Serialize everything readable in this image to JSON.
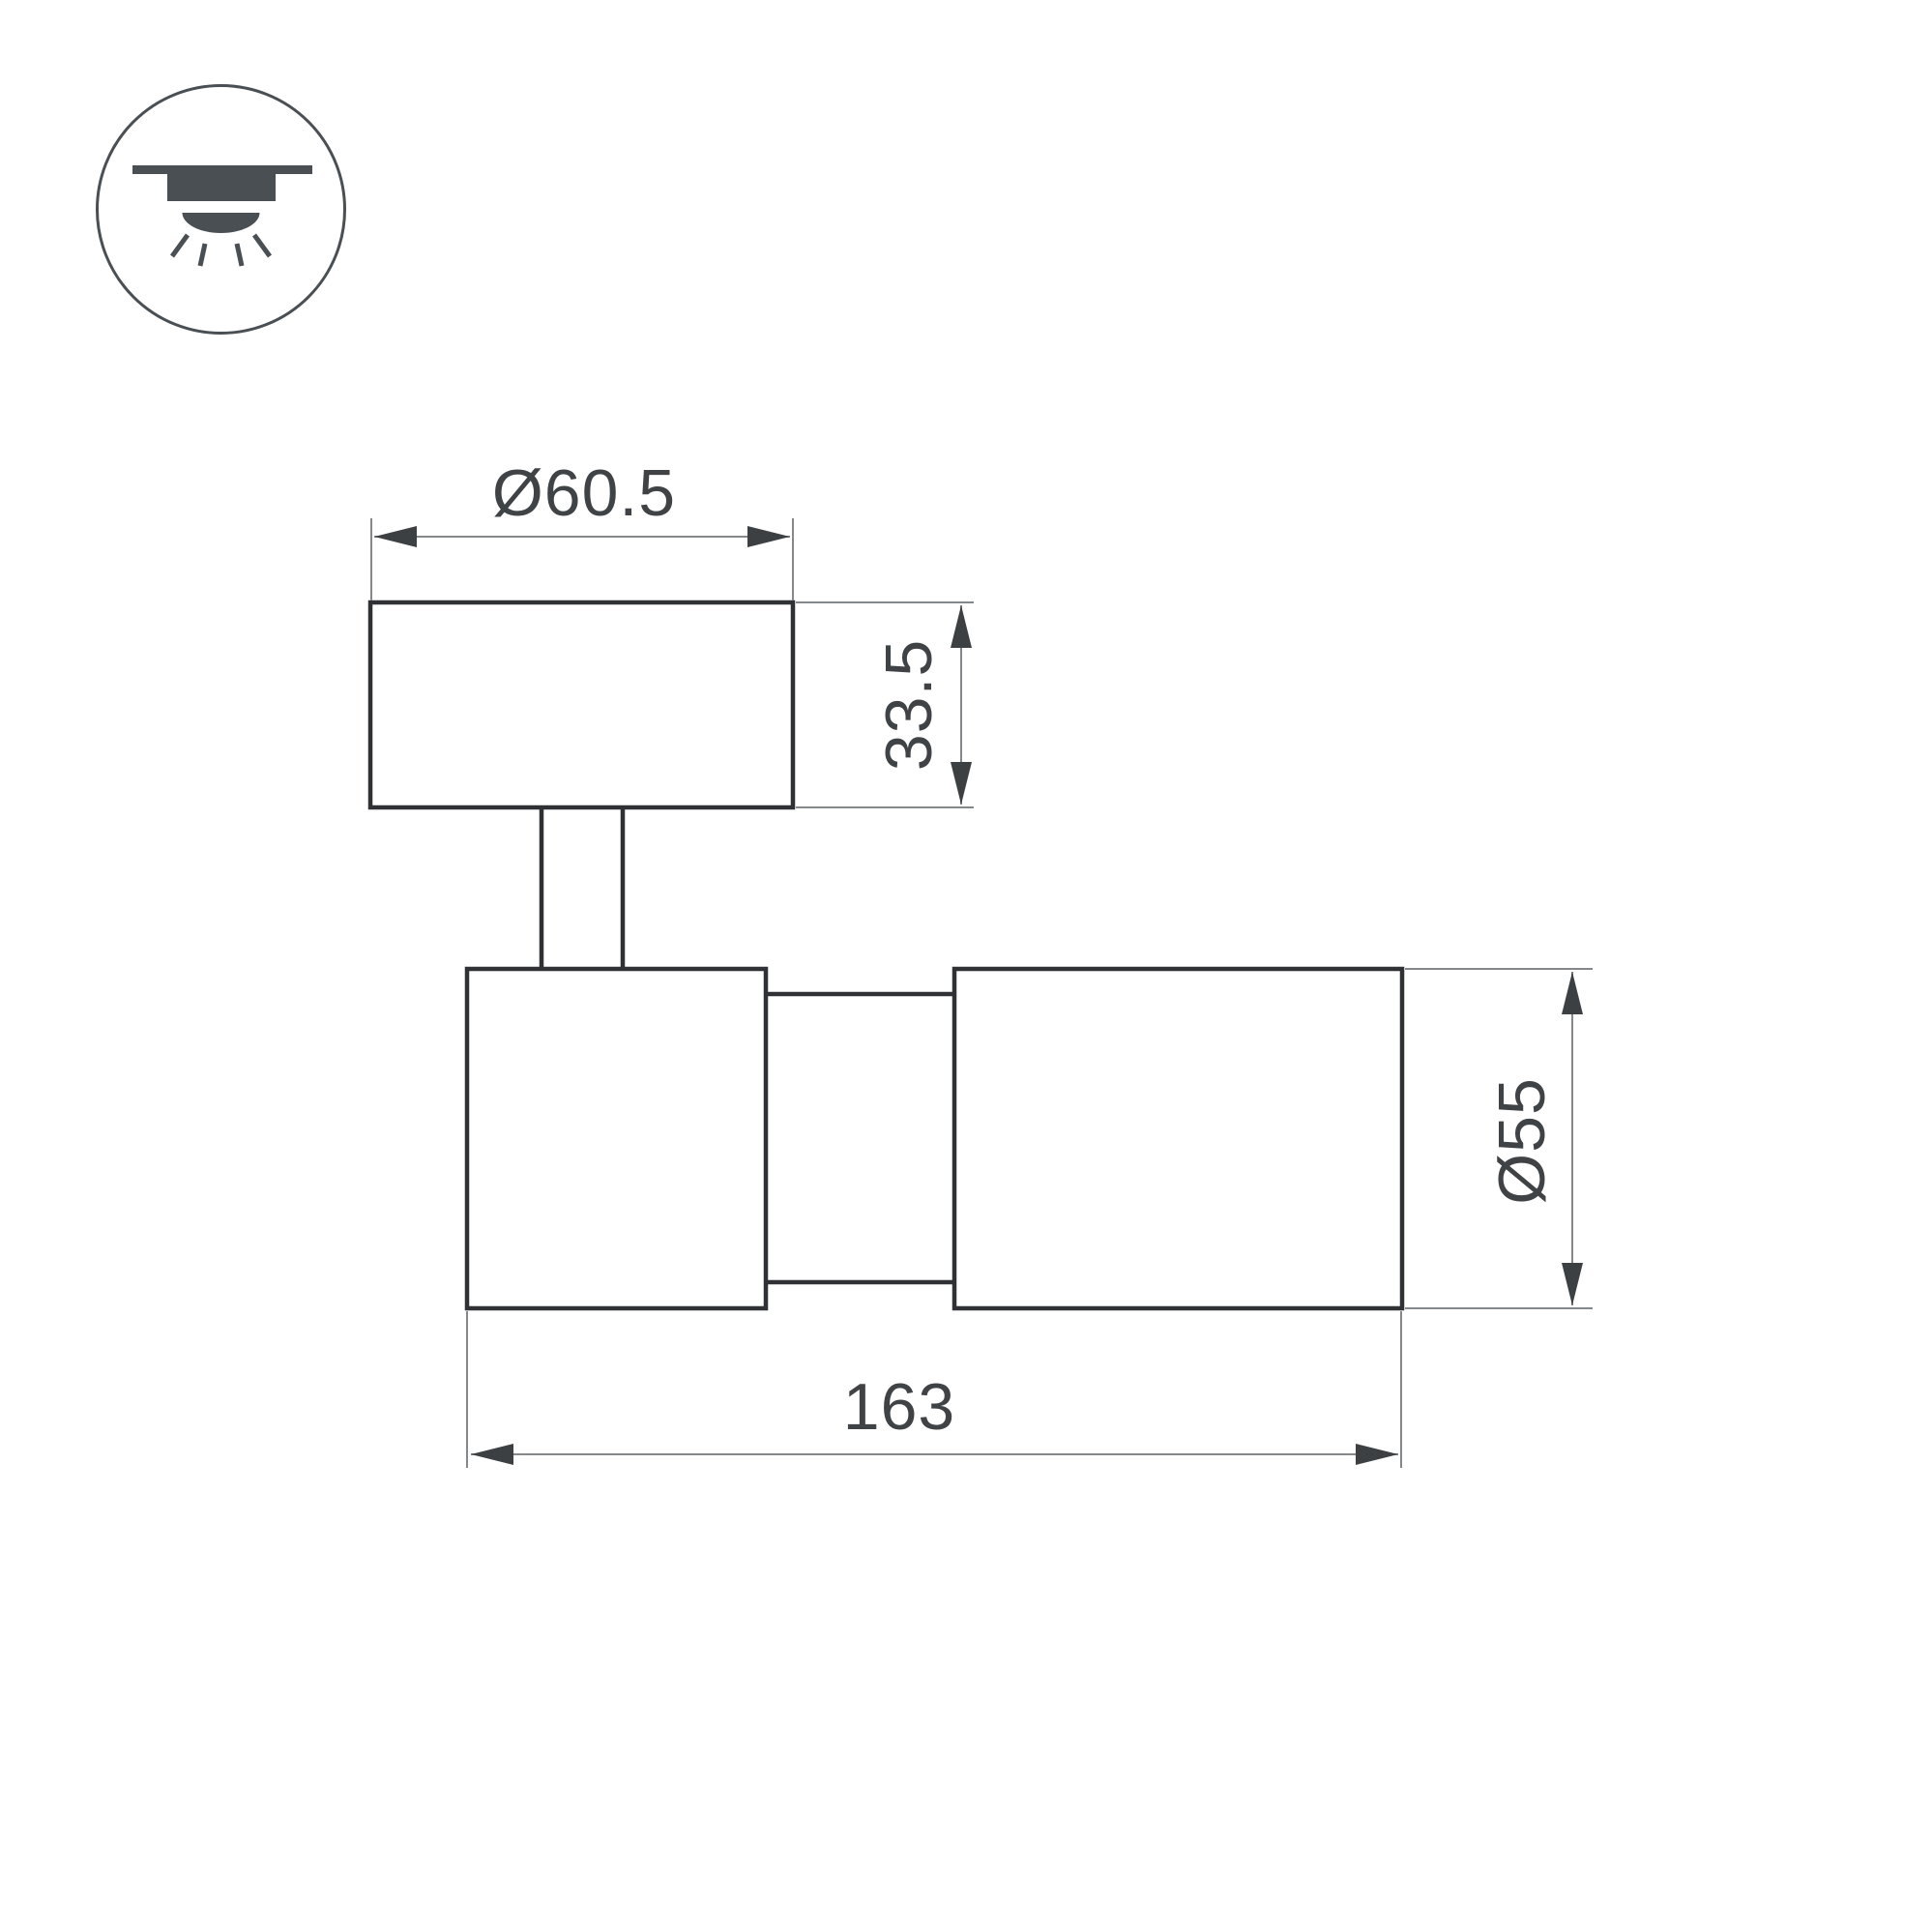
{
  "page": {
    "background": "#ffffff"
  },
  "icon": {
    "name": "ceiling-surface-mount-downlight",
    "color": "#4a4f54",
    "circle_stroke": "#4a4f54"
  },
  "drawing": {
    "outline_color": "#2f3134",
    "dimension_line_color": "#85888b",
    "arrow_color": "#3d4043",
    "label_color": "#404346",
    "labels": {
      "canopy_diameter": "Ø60.5",
      "canopy_height": "33.5",
      "body_diameter": "Ø55",
      "body_length": "163"
    }
  }
}
